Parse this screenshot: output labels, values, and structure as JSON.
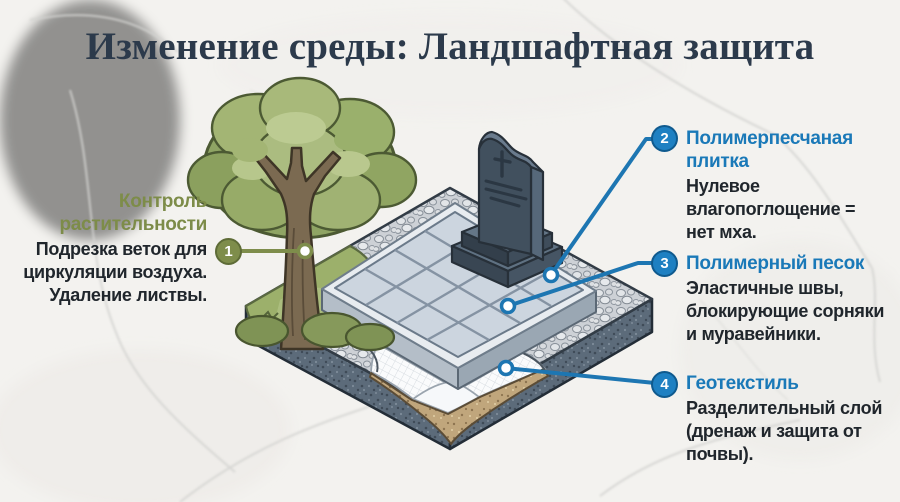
{
  "title": "Изменение среды: Ландшафтная защита",
  "colors": {
    "accent_blue": "#1d76b2",
    "accent_green": "#7e8d4b",
    "title_color": "#2c3a4b",
    "body_color": "#20262c",
    "background": "#f3f2ef"
  },
  "callouts": {
    "vegetation": {
      "number": "1",
      "title": "Контроль\nрастительности",
      "body": "Подрезка веток для\nциркуляции воздуха.\nУдаление листвы."
    },
    "tile": {
      "number": "2",
      "title": "Полимерпесчаная\nплитка",
      "body": "Нулевое\nвлагопоглощение =\nнет мха."
    },
    "sand": {
      "number": "3",
      "title": "Полимерный песок",
      "body": "Эластичные швы,\nблокирующие сорняки\nи муравейники."
    },
    "geotextile": {
      "number": "4",
      "title": "Геотекстиль",
      "body": "Разделительный слой\n(дренаж и защита от\nпочвы)."
    }
  },
  "illustration": {
    "scene": "Изометрический участок захоронения: памятник на плитке, гравий, геотекстиль, дерево"
  }
}
